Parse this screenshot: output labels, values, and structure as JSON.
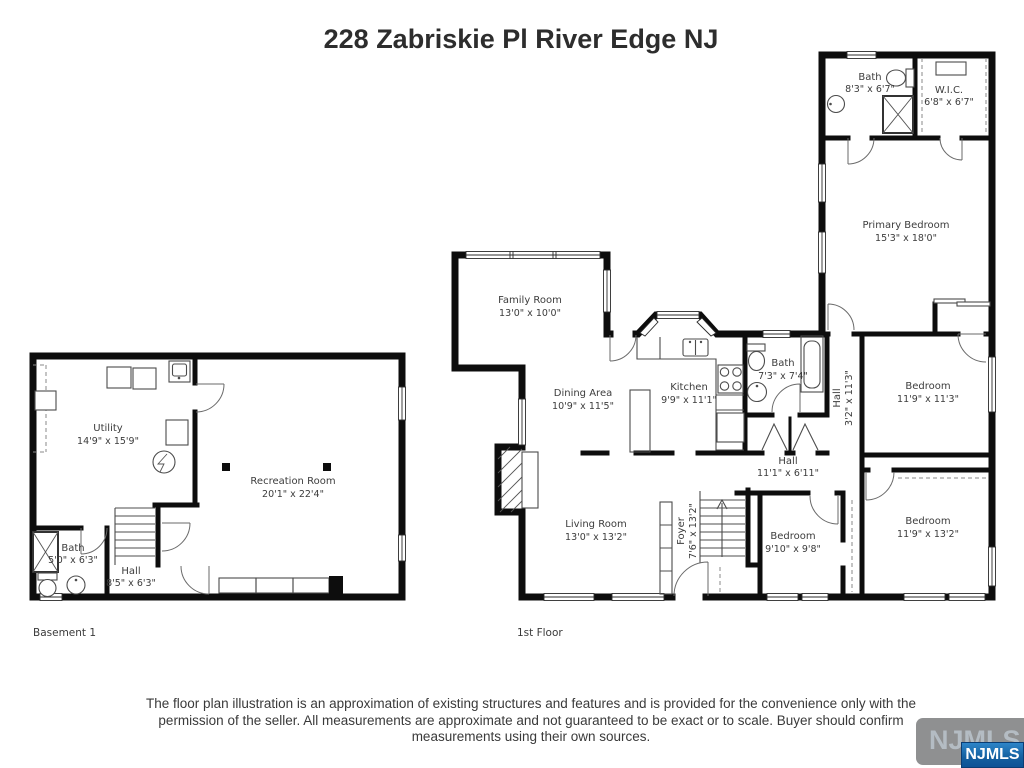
{
  "title": "228 Zabriskie Pl River Edge NJ",
  "floors": {
    "basement": {
      "label": "Basement 1",
      "rooms": {
        "utility": {
          "name": "Utility",
          "dims": "14'9\" x 15'9\""
        },
        "recreation": {
          "name": "Recreation Room",
          "dims": "20'1\" x 22'4\""
        },
        "bath": {
          "name": "Bath",
          "dims": "5'0\" x 6'3\""
        },
        "hall": {
          "name": "Hall",
          "dims": "8'5\" x 6'3\""
        }
      }
    },
    "first": {
      "label": "1st Floor",
      "rooms": {
        "bath_top": {
          "name": "Bath",
          "dims": "8'3\" x 6'7\""
        },
        "wic": {
          "name": "W.I.C.",
          "dims": "6'8\" x 6'7\""
        },
        "primary": {
          "name": "Primary Bedroom",
          "dims": "15'3\" x 18'0\""
        },
        "family": {
          "name": "Family Room",
          "dims": "13'0\" x 10'0\""
        },
        "dining": {
          "name": "Dining Area",
          "dims": "10'9\" x 11'5\""
        },
        "kitchen": {
          "name": "Kitchen",
          "dims": "9'9\" x 11'1\""
        },
        "bath_mid": {
          "name": "Bath",
          "dims": "7'3\" x 7'4\""
        },
        "hall_vert": {
          "name": "Hall",
          "dims": "3'2\" x 11'3\""
        },
        "bedroom_ne": {
          "name": "Bedroom",
          "dims": "11'9\" x 11'3\""
        },
        "hall_main": {
          "name": "Hall",
          "dims": "11'1\" x 6'11\""
        },
        "living": {
          "name": "Living Room",
          "dims": "13'0\" x 13'2\""
        },
        "foyer": {
          "name": "Foyer",
          "dims": "7'6\" x 13'2\""
        },
        "bedroom_sw": {
          "name": "Bedroom",
          "dims": "9'10\" x 9'8\""
        },
        "bedroom_se": {
          "name": "Bedroom",
          "dims": "11'9\" x 13'2\""
        }
      }
    }
  },
  "disclaimer": {
    "lines": [
      "The floor plan illustration is an approximation of existing structures and features and is provided for the convenience only with the",
      "permission of the seller. All measurements are approximate and not guaranteed to be exact or to scale. Buyer should confirm",
      "measurements using their own sources."
    ]
  },
  "logo": {
    "text": "NJMLS",
    "overlay_text": "NJMLS",
    "gray_color": "#8f9091",
    "blue_color": "#135f9f"
  },
  "colors": {
    "wall": "#0d0d0d",
    "label_text": "#3c3c3c",
    "title_text": "#2d2d2d"
  }
}
